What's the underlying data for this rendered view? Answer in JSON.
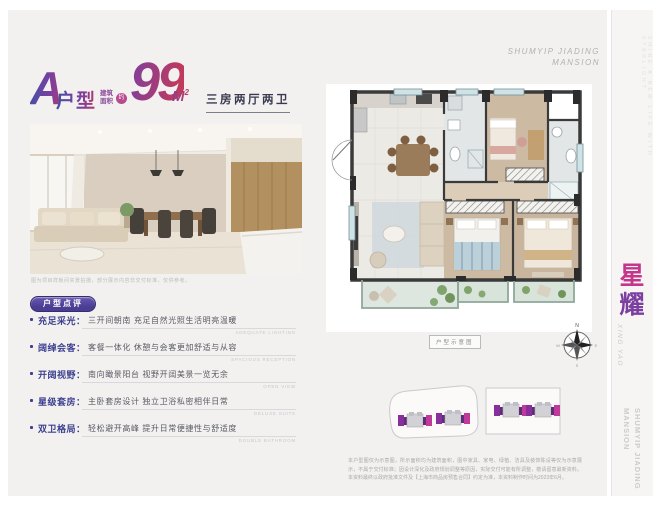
{
  "header": {
    "unit_letter": "A",
    "unit_type": "户型",
    "area_label_line1": "建筑",
    "area_label_line2": "面积",
    "area_approx": "约",
    "area_value": "99",
    "area_unit": "M",
    "area_sup": "2",
    "layout_text": "三房两厅两卫",
    "brand_line1": "SHUMYIP JIADING",
    "brand_line2": "MANSION"
  },
  "photo": {
    "caption": "图为项目样板间实景拍摄，部分展示内容非交付标准，仅供参考。"
  },
  "review": {
    "badge": "户型点评",
    "items": [
      {
        "label": "充足采光：",
        "text": "三开间朝南 充足自然光照生活明亮温暖",
        "en": "ADEQUATE LIGHTING"
      },
      {
        "label": "阔绰会客：",
        "text": "客餐一体化 休憩与会客更加舒适与从容",
        "en": "SPACIOUS RECEPTION"
      },
      {
        "label": "开阔视野：",
        "text": "南向瞰景阳台 视野开阔美景一览无余",
        "en": "OPEN VIEW"
      },
      {
        "label": "星级套房：",
        "text": "主卧套房设计 独立卫浴私密相伴日常",
        "en": "DELUXE SUITE"
      },
      {
        "label": "双卫格局：",
        "text": "轻松避开高峰 提升日常便捷性与舒适度",
        "en": "DOUBLE BATHROOM"
      }
    ]
  },
  "plan": {
    "caption": "户型示意图",
    "compass": {
      "n": "N",
      "e": "E",
      "s": "S",
      "w": "W"
    }
  },
  "disclaimer": "本户型图仅为示意图，所示面积均为建筑面积，图中家具、家电、绿植、洁具及装饰陈设等仅为示意展示，不属于交付标准；因设计深化及政府规划调整等原因，实际交付可能有所调整，敬请留意最新资料。本资料最终以政府批准文件及【上海市商品房预售合同】约定为准，本资料制作时间为2023年6月。",
  "sidebar": {
    "logo_char1": "星",
    "logo_char2": "耀",
    "logo_en": "XING YAO",
    "tagline": "SHINE A NEW LIFE WITH STARLIGHT",
    "bottom_text": "SHUMYIP JIADING MANSION"
  },
  "colors": {
    "brand-blue": "#4050a8",
    "brand-purple": "#7b3fa0",
    "brand-red": "#c03a5e",
    "brand-magenta": "#c4368c",
    "label-indigo": "#3c3f8f"
  }
}
